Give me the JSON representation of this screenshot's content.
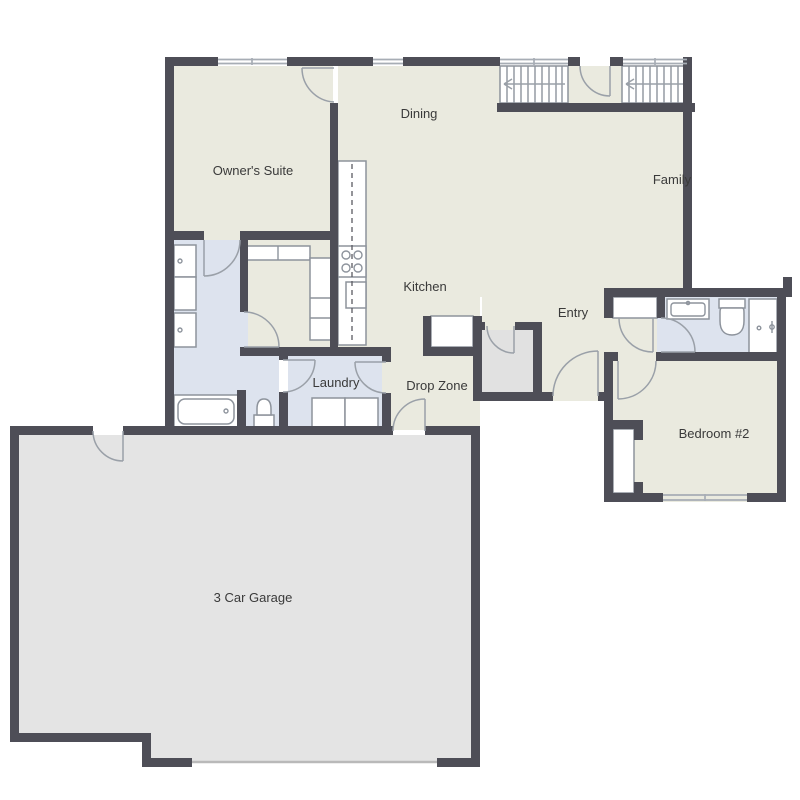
{
  "rooms": {
    "owners_suite": {
      "label": "Owner's Suite"
    },
    "dining": {
      "label": "Dining"
    },
    "family": {
      "label": "Family"
    },
    "kitchen": {
      "label": "Kitchen"
    },
    "entry": {
      "label": "Entry"
    },
    "laundry": {
      "label": "Laundry"
    },
    "drop_zone": {
      "label": "Drop Zone"
    },
    "bedroom_2": {
      "label": "Bedroom #2"
    },
    "garage": {
      "label": "3 Car Garage"
    }
  },
  "colors": {
    "wall": "#4e4e57",
    "living": "#eaeadf",
    "wet": "#dde3ee",
    "garage": "#e4e4e4",
    "closet": "#e1e1e1",
    "line": "#8d939c",
    "door_line": "#9aa0a8",
    "window_line": "#a7adb5",
    "label": "#3a3a3a"
  }
}
